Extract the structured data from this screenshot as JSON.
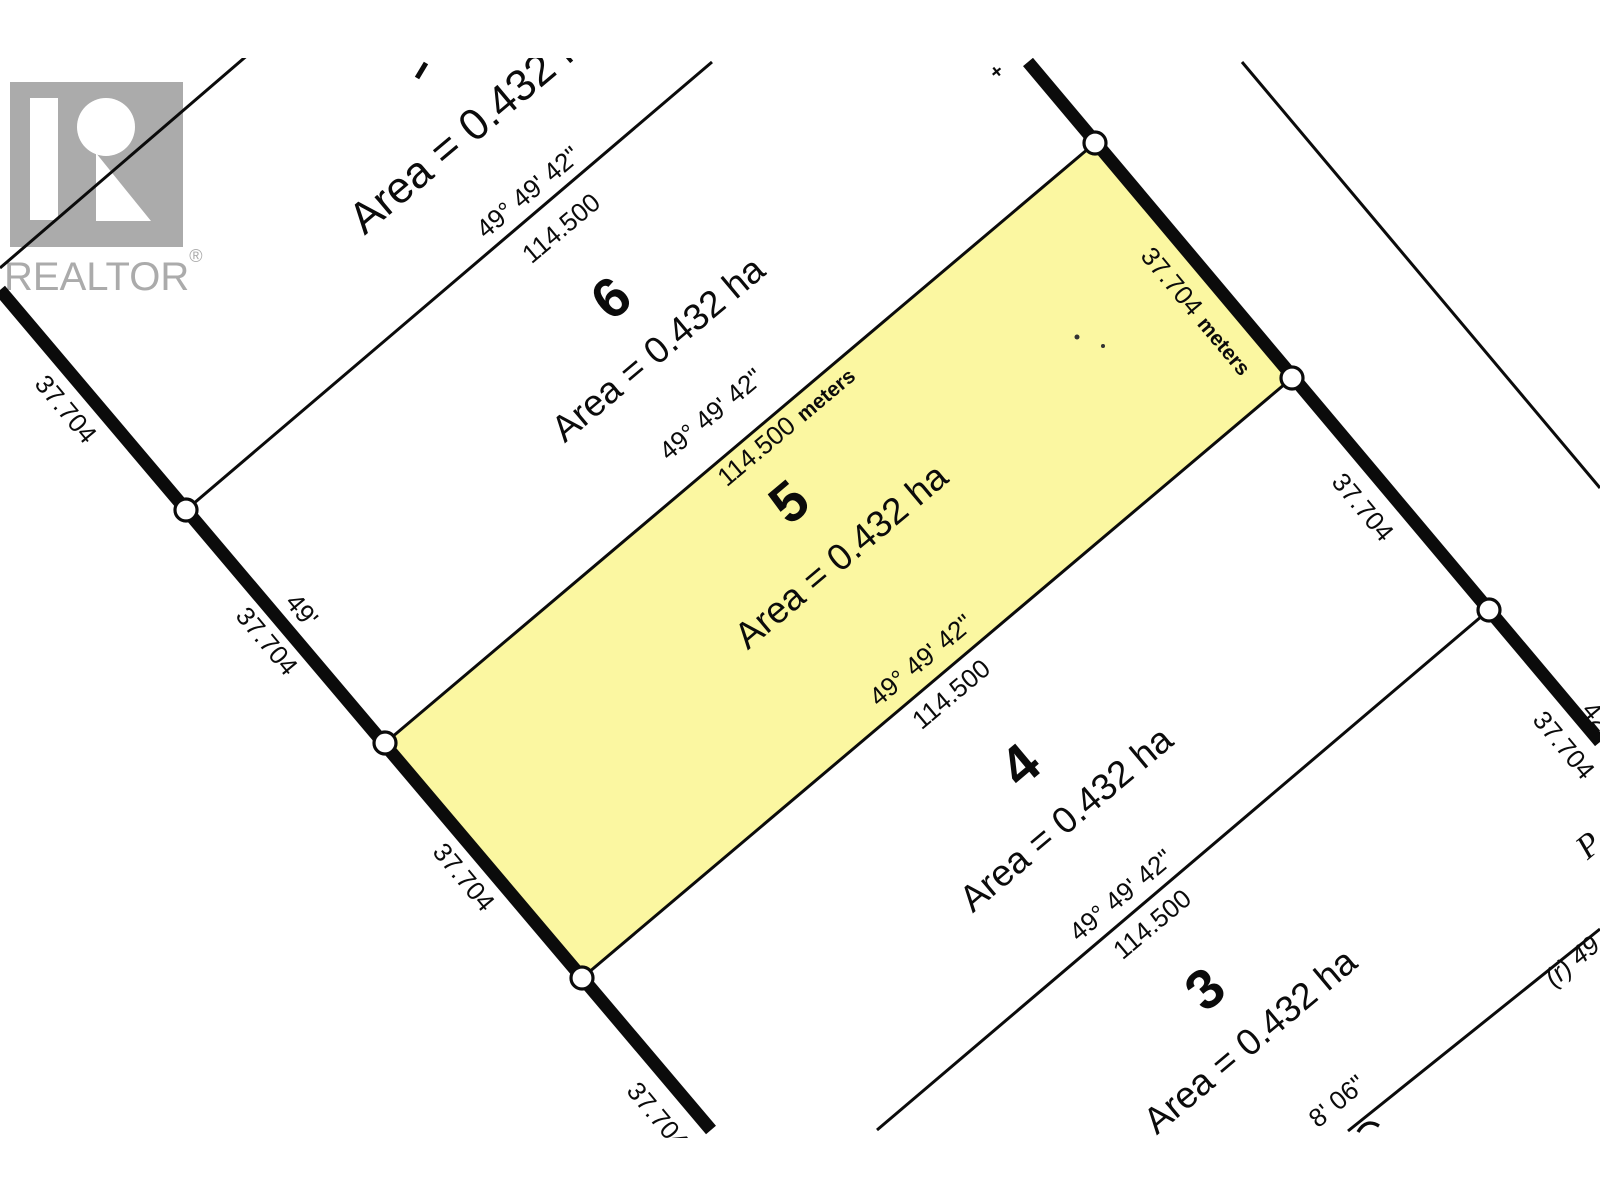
{
  "colors": {
    "highlight": "#fbf7a1",
    "ink": "#0b0b0b",
    "logo_gray": "#ababab"
  },
  "watermark": {
    "brand": "REALTOR",
    "registered": "®"
  },
  "lots": {
    "lot7_area_partial": "Area = 0.432 ha",
    "lot6": {
      "number": "6",
      "area": "Area = 0.432 ha"
    },
    "lot5": {
      "number": "5",
      "area": "Area = 0.432 ha"
    },
    "lot4": {
      "number": "4",
      "area": "Area = 0.432 ha"
    },
    "lot3": {
      "number": "3",
      "area": "Area = 0.432 ha"
    }
  },
  "boundaries": {
    "b67": {
      "bearing": "49° 49' 42\"",
      "distance": "114.500"
    },
    "b56": {
      "bearing": "49° 49' 42\"",
      "distance": "114.500",
      "unit": "meters"
    },
    "b45": {
      "bearing": "49° 49' 42\"",
      "distance": "114.500"
    },
    "b34": {
      "bearing": "49° 49' 42\"",
      "distance": "114.500"
    },
    "b23": {
      "bearing_fragment": "8' 06\"",
      "reference_fragment": "(r) 49"
    }
  },
  "west_road": {
    "seg1": "37.704",
    "label_49ft": "49'",
    "seg2": "37.704",
    "seg3": "37.704",
    "seg4": "37.704"
  },
  "east_road": {
    "seg1": "37.704",
    "seg1_unit": "meters",
    "seg2": "37.704",
    "seg3": "37.704",
    "fragment": "42"
  },
  "fragments": {
    "plan_text": "P",
    "plus_mark": "+"
  }
}
